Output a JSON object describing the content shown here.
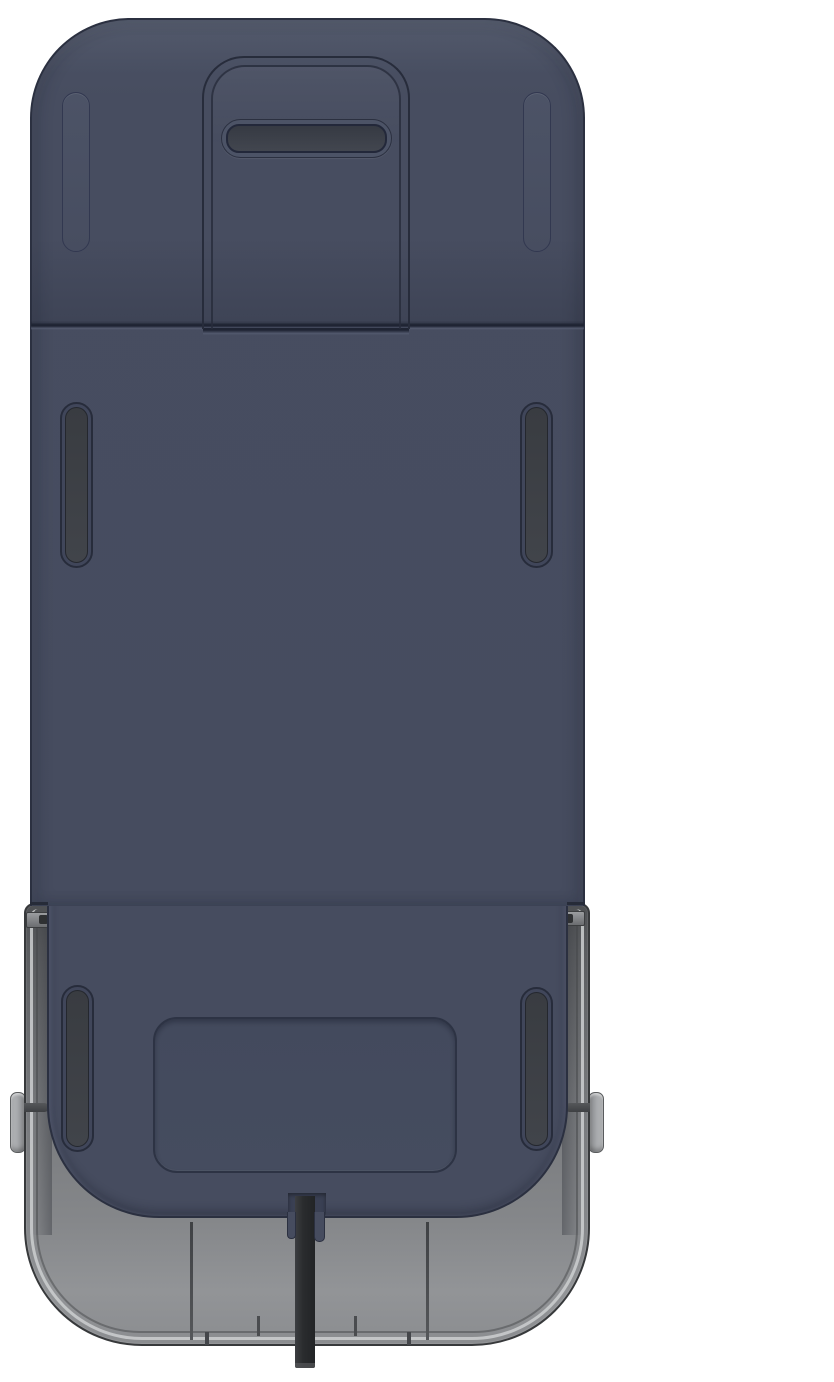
{
  "meta": {
    "description": "3D product render, bottom/underside view of a dark navy rectangular device with rounded corners sitting in a translucent gray base tray, black power cable exiting bottom center",
    "view": "underside orthographic render",
    "visible_text": "none"
  },
  "colors": {
    "bg": "#ffffff",
    "body_navy": "#464c5f",
    "body_navy_light": "#4c5366",
    "body_outline": "#2b3040",
    "groove_dark": "#272c3b",
    "seam_dark": "#1f2433",
    "seam_light": "#5c6378",
    "slot_fill_dark": "#41444a",
    "handle_fill_dark": "#42464f",
    "panel_fill": "#434a5d",
    "tray_dark": "#4e5053",
    "tray_mid": "#77797c",
    "tray_light": "#929497",
    "tray_edge": "#37393b",
    "rim_light": "#cdcfd1",
    "clip_gray": "#6b6d70",
    "knob_gray": "#a7a9ac",
    "pin_dark": "#3e4043",
    "cable_dark": "#222426",
    "cable_light": "#3c3e41",
    "cable_tip": "#55575a"
  },
  "parts": [
    {
      "name": "base-tray",
      "description": "gray translucent tray base with rounded bottom corners and double rim line"
    },
    {
      "name": "device-body-upper",
      "description": "navy top cap section above horizontal seam, rounded top corners"
    },
    {
      "name": "device-body-lower",
      "description": "navy main underside panel with rounded bottom corners"
    },
    {
      "name": "handle-channel",
      "description": "recessed U-channel groove at top center"
    },
    {
      "name": "handle-grip-slot",
      "description": "horizontal dark pill slot inside channel"
    },
    {
      "name": "cap-foot-left",
      "description": "embossed vertical pill near top-left corner"
    },
    {
      "name": "cap-foot-right",
      "description": "embossed vertical pill near top-right corner"
    },
    {
      "name": "vent-slot-top-left",
      "description": "dark vertical slot, upper left of main panel"
    },
    {
      "name": "vent-slot-top-right",
      "description": "dark vertical slot, upper right of main panel"
    },
    {
      "name": "vent-slot-bottom-left",
      "description": "dark vertical slot, lower left of main panel"
    },
    {
      "name": "vent-slot-bottom-right",
      "description": "dark vertical slot, lower right of main panel"
    },
    {
      "name": "label-recess-panel",
      "description": "recessed rounded rectangle label area, bottom center"
    },
    {
      "name": "side-knob-left",
      "description": "light gray latch knob protruding from left tray wall"
    },
    {
      "name": "side-knob-right",
      "description": "light gray latch knob protruding from right tray wall"
    },
    {
      "name": "power-cable",
      "description": "black cable exiting notch at bottom center"
    }
  ]
}
